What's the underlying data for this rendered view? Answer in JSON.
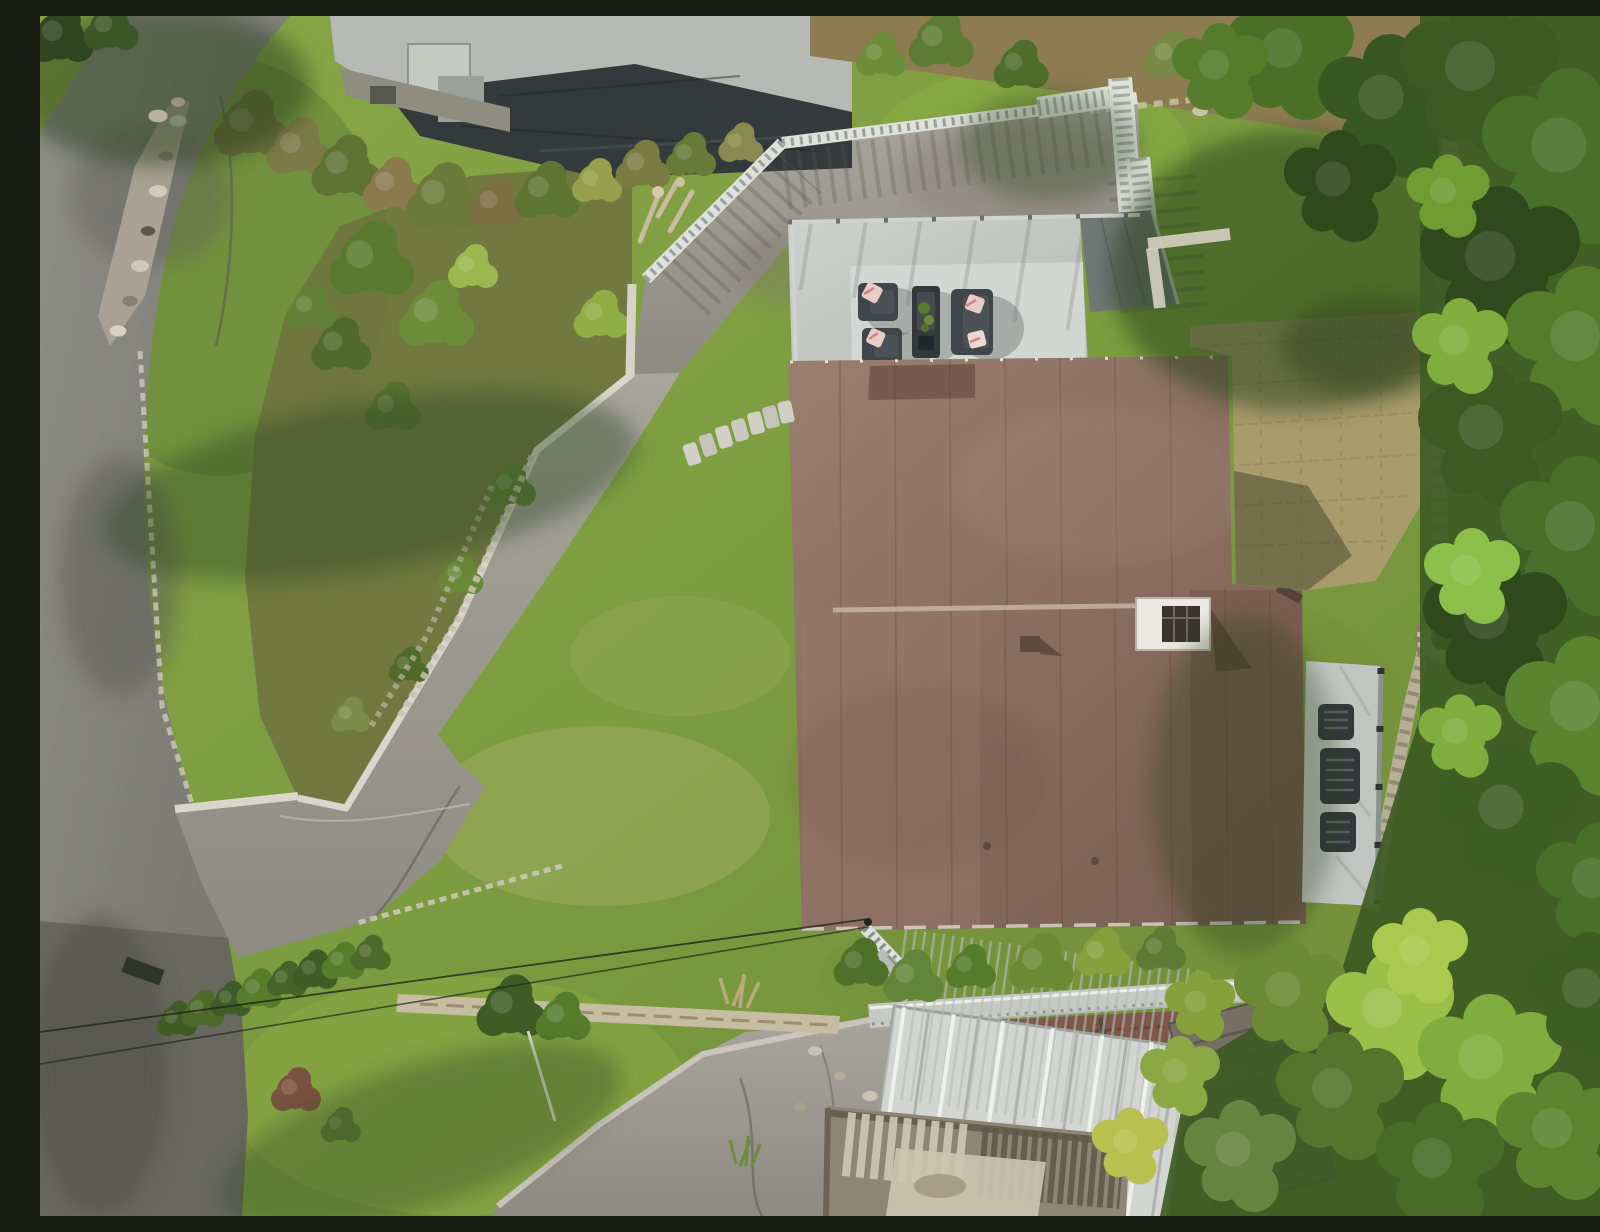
{
  "scene": {
    "title": "Aerial drone view of hillside property",
    "description": "Top-down sunny aerial photograph of a hillside residential lot: a large brown flat-roofed house with rooftop chimney, a light grey roof deck with dark outdoor lounge furniture and blush pillows, a white picket fence along an asphalt parking apron, a long curved driveway descending to a road junction, terraced rock gardens, bright lawns, a tan paver courtyard with stone wall and fire pit, a side balcony with wicker chairs, lower carport with white corrugated roof, weathered wooden stairs, a metal access ramp, power lines, and dense green conifer trees along the right edge.",
    "lighting": "daytime, hard sun from upper right, long shadows to lower-left",
    "palette": {
      "lawn_bright": "#86a546",
      "lawn_olive": "#6f8d39",
      "road_asphalt": "#80807a",
      "driveway_concrete": "#a3a098",
      "curb_white": "#d9d6cc",
      "roof_brown_main": "#8b6e61",
      "roof_brown_wing": "#7a5a4f",
      "neighbor_roof_light": "#b6b9b5",
      "neighbor_roof_dark": "#343a3c",
      "deck_grey": "#c6cac6",
      "fence_white": "#dfe1dc",
      "furniture_charcoal": "#3f4548",
      "pillow_blush": "#e8cdc6",
      "paver_tan": "#a89b6c",
      "brick_red": "#7e584a",
      "carport_white": "#d2d5d1",
      "conifer_dark": "#2f481c",
      "conifer_bright": "#7fae3f",
      "stone_light": "#cfc9ba",
      "fire_pit_stone": "#c6bfae"
    },
    "objects": {
      "main_house": {
        "roof": "brown membrane, two joined flat sections",
        "chimney": "white cap with dark flue",
        "roof_vents": 2
      },
      "roof_deck": {
        "furniture": [
          "armchair",
          "armchair",
          "fire table with plants",
          "loveseat"
        ],
        "pillow_color": "blush pink",
        "railing": "glass with posts"
      },
      "balcony": {
        "chairs": 3,
        "railing": "glass"
      },
      "driveway": {
        "shape": "S-curve from upper apron to road junction",
        "curb": "white painted"
      },
      "road": {
        "position": "left edge, runs top to bottom"
      },
      "courtyard": {
        "surface": "herringbone pavers",
        "feature": "round stone fire pit"
      },
      "carport": {
        "roof": "white corrugated metal"
      },
      "power_lines": 2,
      "stepping_stones": 7,
      "neighbor_house": {
        "roof": "light grey flat + dark charcoal ribbed section"
      }
    }
  }
}
